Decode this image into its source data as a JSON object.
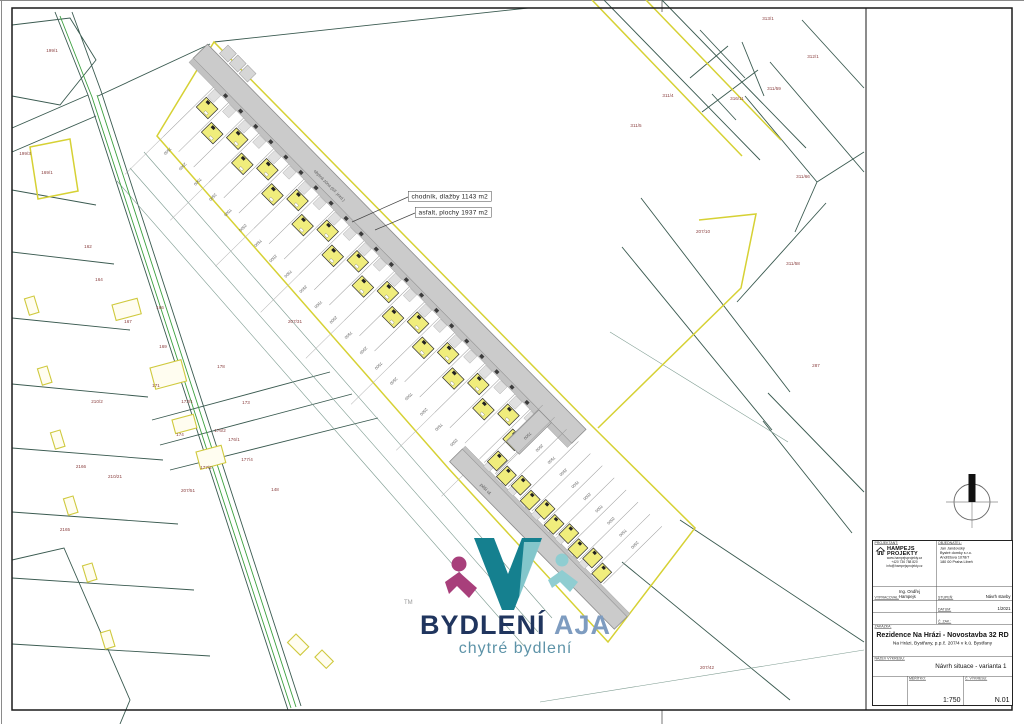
{
  "annotations": {
    "label_sidewalk": "chodník, dlažby 1143 m2",
    "label_asphalt": "asfalt, plochy 1937 m2"
  },
  "site": {
    "band_a_count": 22,
    "band_b_count": 10,
    "lot_dims": [
      "7500",
      "2500"
    ],
    "street_label_a": "obytná zóna (šíř. jezd.)",
    "street_label_b": "pěší ul.",
    "house_fill": "#f0ed7c",
    "boundary_color": "#d6d134"
  },
  "parcel_labels": [
    {
      "t": "199/1",
      "x": 52,
      "y": 52
    },
    {
      "t": "199/3",
      "x": 25,
      "y": 155
    },
    {
      "t": "313/1",
      "x": 768,
      "y": 20
    },
    {
      "t": "312/1",
      "x": 813,
      "y": 58
    },
    {
      "t": "311/4",
      "x": 668,
      "y": 97
    },
    {
      "t": "311/5",
      "x": 636,
      "y": 127
    },
    {
      "t": "316/11",
      "x": 737,
      "y": 100
    },
    {
      "t": "311/59",
      "x": 774,
      "y": 90
    },
    {
      "t": "311/66",
      "x": 803,
      "y": 178
    },
    {
      "t": "311/58",
      "x": 793,
      "y": 265
    },
    {
      "t": "287",
      "x": 816,
      "y": 367
    },
    {
      "t": "207/10",
      "x": 703,
      "y": 233
    },
    {
      "t": "207/31",
      "x": 295,
      "y": 323
    },
    {
      "t": "207/42",
      "x": 707,
      "y": 669
    },
    {
      "t": "169/1",
      "x": 47,
      "y": 174
    },
    {
      "t": "162",
      "x": 88,
      "y": 248
    },
    {
      "t": "164",
      "x": 99,
      "y": 281
    },
    {
      "t": "166",
      "x": 160,
      "y": 309
    },
    {
      "t": "167",
      "x": 128,
      "y": 323
    },
    {
      "t": "169",
      "x": 163,
      "y": 348
    },
    {
      "t": "171",
      "x": 156,
      "y": 387
    },
    {
      "t": "173/1",
      "x": 187,
      "y": 403
    },
    {
      "t": "178",
      "x": 221,
      "y": 368
    },
    {
      "t": "173",
      "x": 246,
      "y": 404
    },
    {
      "t": "174",
      "x": 180,
      "y": 436
    },
    {
      "t": "176/2",
      "x": 220,
      "y": 432
    },
    {
      "t": "176/1",
      "x": 234,
      "y": 441
    },
    {
      "t": "177/4",
      "x": 247,
      "y": 461
    },
    {
      "t": "177/2",
      "x": 206,
      "y": 469
    },
    {
      "t": "210/2",
      "x": 97,
      "y": 403
    },
    {
      "t": "210/21",
      "x": 115,
      "y": 478
    },
    {
      "t": "2165",
      "x": 65,
      "y": 531
    },
    {
      "t": "2166",
      "x": 81,
      "y": 468
    },
    {
      "t": "207/51",
      "x": 188,
      "y": 492
    },
    {
      "t": "148",
      "x": 275,
      "y": 491
    }
  ],
  "logo": {
    "brand_primary": "BYDLENÍ",
    "brand_secondary": "AJA",
    "tagline": "chytré bydlení",
    "trademark": "TM",
    "color_primary": "#20355e",
    "color_secondary": "#7e9cc0",
    "color_tagline": "#5d93a8",
    "mark_teal": "#15808f",
    "mark_teal_light": "#8fcdd1",
    "mark_magenta": "#a83f7b"
  },
  "title_block": {
    "designer_label": "PROJEKTANT:",
    "firm_line1": "HAMPEJS",
    "firm_line2": "PROJEKTY",
    "firm_contact1": "www.hampejsprojekty.cz",
    "firm_contact2": "+420 736 788 820",
    "firm_contact3": "info@hampejsprojekty.cz",
    "client_label": "OBJEDNATEL:",
    "client_line1": "Jan Jandovský",
    "client_line2": "Bystré domky s.r.o.",
    "client_line3": "Andrštova 1078/7",
    "client_line4": "180 00 Praha Libeň",
    "drafted_label": "VYPRACOVAL:",
    "drafted_value": "Ing. Ondřej Hampejs",
    "stage_label": "STUPEŇ:",
    "stage_value": "Návrh stavby",
    "date_label": "DATUM:",
    "date_value": "1/2021",
    "order_label": "Č. ZAK.:",
    "order_value": "",
    "job_label": "ZAKÁZKA:",
    "job_title": "Rezidence Na Hrázi - Novostavba 32 RD",
    "job_subtitle": "Na Hrázi, Bystřany, p.p.č. 207/4 v k.ú. Bystřany",
    "drawing_label": "NÁZEV VÝKRESU:",
    "drawing_value": "Návrh situace - varianta 1",
    "scale_label": "MĚŘÍTKO:",
    "scale_value": "1:750",
    "number_label": "Č. VÝKRESU:",
    "number_value": "N.01"
  }
}
